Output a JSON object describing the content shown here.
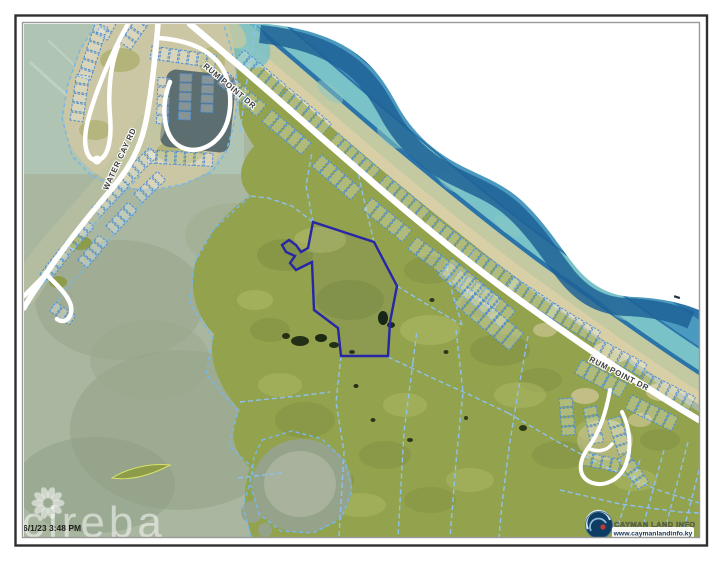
{
  "map": {
    "roads": {
      "rum_point_dr": "RUM POINT DR",
      "water_cay_rd": "WATER CAY RD"
    },
    "timestamp": "6/1/23 3:48 PM",
    "watermark": "cireba",
    "branding": {
      "name": "CAYMAN LAND INFO",
      "url": "www.caymanlandinfo.ky"
    }
  },
  "colors": {
    "ocean_deep": "#2b74a9",
    "ocean_mid": "#4a9ac0",
    "ocean_turquoise": "#79c2c8",
    "reef": "#c3c9a1",
    "beach_sand": "#d8cfa6",
    "lagoon": "#a9b7a0",
    "land": "#93a24c",
    "sandbar": "#cbc7a4",
    "canal_water": "#5d6e70",
    "parcel_line": "#4f8fd6",
    "cadastral_line": "#8ec1ec",
    "coast_line": "#79b7e4",
    "highlight_parcel": "#2626a6",
    "road": "#ffffff",
    "logo_gold": "#8f7d2e",
    "logo_navy": "#16365c"
  }
}
